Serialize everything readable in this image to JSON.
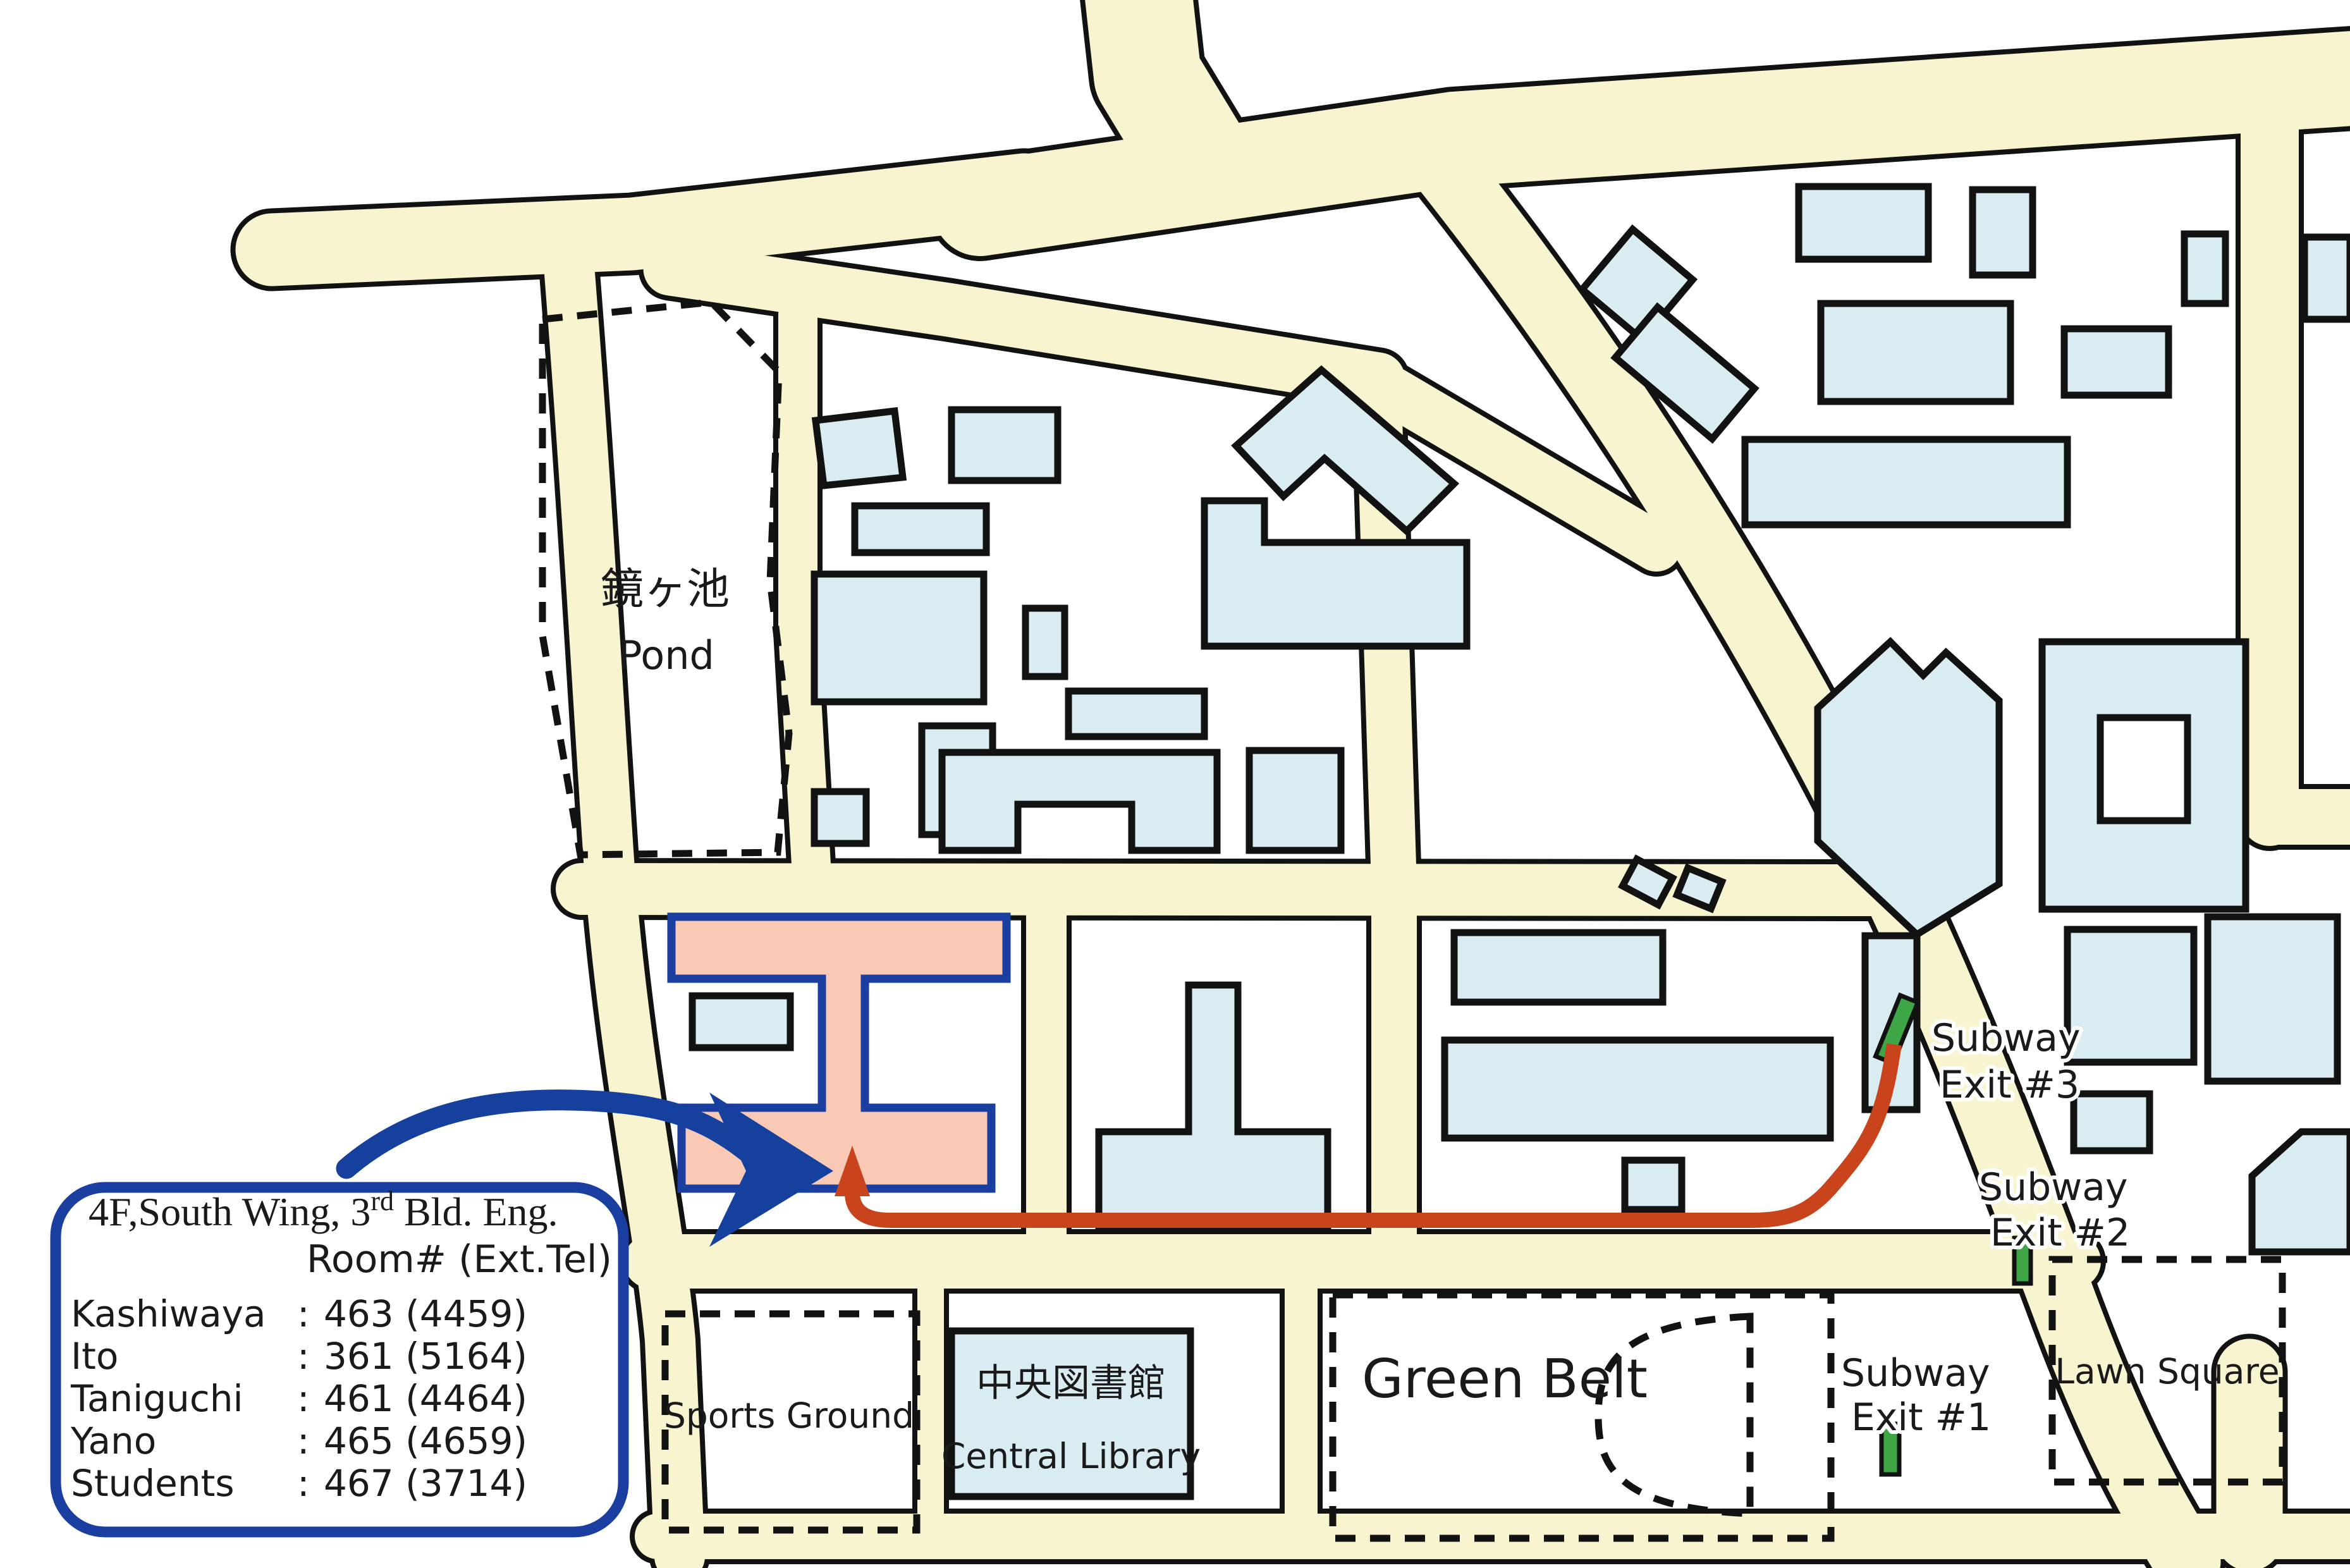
{
  "map": {
    "pond": {
      "jp": "鏡ヶ池",
      "en": "Pond"
    },
    "sports_ground": "Sports Ground",
    "library": {
      "jp": "中央図書館",
      "en": "Central Library"
    },
    "green_belt": "Green Belt",
    "lawn_square": "Lawn Square",
    "subway_exits": [
      {
        "line1": "Subway",
        "line2": "Exit #3"
      },
      {
        "line1": "Subway",
        "line2": "Exit #2"
      },
      {
        "line1": "Subway",
        "line2": "Exit #1"
      }
    ]
  },
  "callout": {
    "title_pre": "4F,South Wing, 3",
    "title_sup": "rd",
    "title_post": " Bld. Eng.",
    "room_header": "Room#  (Ext.Tel)",
    "colon": ":",
    "staff": [
      {
        "name": "Kashiwaya",
        "value": "463 (4459)"
      },
      {
        "name": "Ito",
        "value": "361 (5164)"
      },
      {
        "name": "Taniguchi",
        "value": "461 (4464)"
      },
      {
        "name": "Yano",
        "value": "465 (4659)"
      },
      {
        "name": "Students",
        "value": "467 (3714)"
      }
    ]
  },
  "colors": {
    "road": "#f7f4cf",
    "casing": "#121212",
    "building": "#d9ecf1",
    "highlight": "#f9c9b6",
    "highlight_stroke": "#1a3fa0",
    "route": "#c9441c",
    "arrow": "#16409e",
    "exit": "#3ea647",
    "ink": "#1a1a1a"
  }
}
